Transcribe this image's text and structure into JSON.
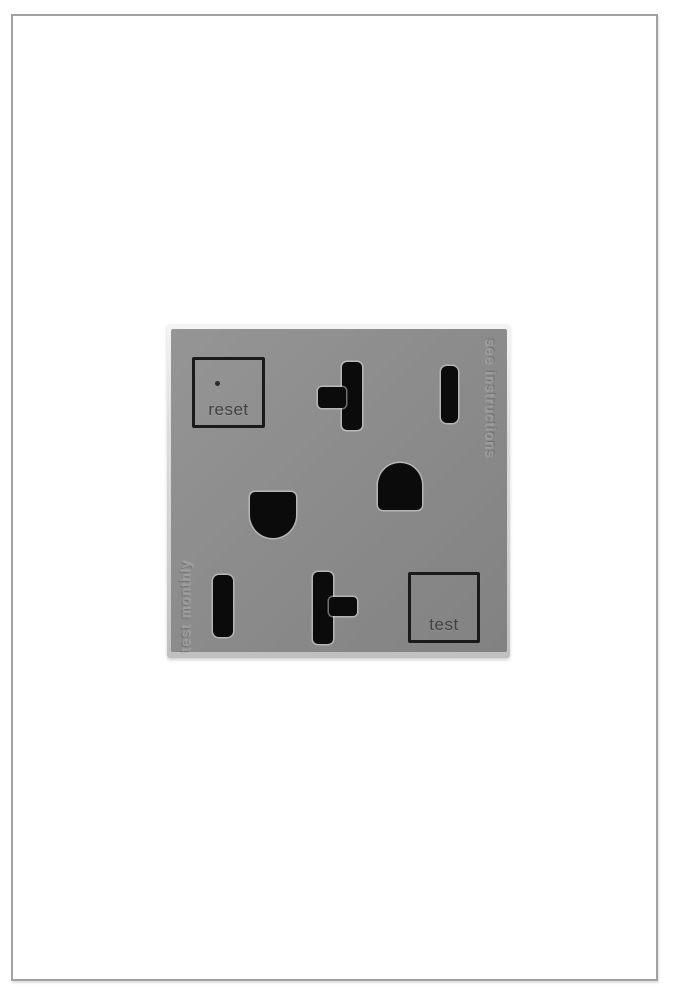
{
  "photo": {
    "description_labels_visible": true,
    "colors": {
      "background": "#ffffff",
      "photo_border": "#a2a2a2",
      "plate_edge": "#dedede",
      "face": "#8b8b8b",
      "slot": "#0b0b0b",
      "button_outline": "#1a1a1a",
      "button_label": "#424242",
      "embossed_text": "#9d9d9d"
    }
  },
  "outlet": {
    "reset_button_label": "reset",
    "test_button_label": "test",
    "embossed_right_text": "see instructions",
    "embossed_left_text": "test monthly",
    "receptacles": [
      {
        "position": "top",
        "slots": [
          "neutral-t-slot",
          "hot-slot",
          "ground-hole"
        ]
      },
      {
        "position": "bottom",
        "slots": [
          "ground-hole",
          "hot-slot",
          "neutral-t-slot"
        ]
      }
    ],
    "indicator": "led-dot-on-reset-button"
  }
}
